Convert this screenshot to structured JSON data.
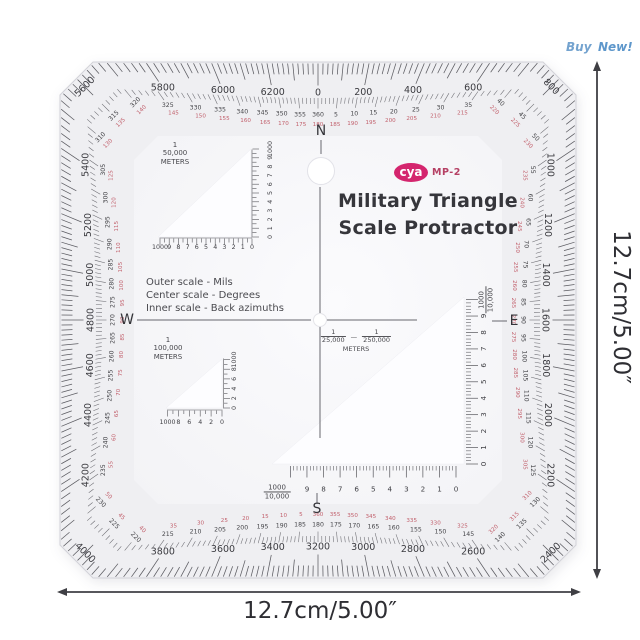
{
  "buy_new": {
    "buy": "Buy",
    "new": "New!"
  },
  "dimensions": {
    "right_label": "12.7cm/5.00″",
    "bottom_label": "12.7cm/5.00″"
  },
  "product": {
    "logo": {
      "brand": "cya",
      "model": "MP-2"
    },
    "title_line1": "Military Triangle",
    "title_line2": "Scale Protractor",
    "notes": [
      "Outer scale - Mils",
      "Center scale - Degrees",
      "Inner scale - Back azimuths"
    ],
    "compass": {
      "north": "N",
      "south": "S",
      "east": "E",
      "west": "W"
    },
    "center_scales": {
      "frac1_num": "1",
      "frac1_den": "25,000",
      "dash": "—",
      "frac2_num": "1",
      "frac2_den": "250,000",
      "unit": "METERS"
    },
    "triangle_50k": {
      "frac_num": "1",
      "frac_den": "50,000",
      "unit": "METERS",
      "bottom_scale": [
        "1000",
        "9",
        "8",
        "7",
        "6",
        "5",
        "4",
        "3",
        "2",
        "1",
        "0"
      ],
      "side_scale": [
        "0",
        "1",
        "2",
        "3",
        "4",
        "5",
        "6",
        "7",
        "8",
        "9",
        "1000"
      ]
    },
    "triangle_100k": {
      "frac_num": "1",
      "frac_den": "100,000",
      "unit": "METERS",
      "bottom_scale": [
        "1000",
        "8",
        "6",
        "4",
        "2",
        "0"
      ],
      "side_scale": [
        "0",
        "2",
        "4",
        "6",
        "8",
        "1000"
      ]
    },
    "triangle_10k": {
      "frac_num": "1000",
      "frac_den": "10,000",
      "bottom_scale": [
        "9",
        "8",
        "7",
        "6",
        "5",
        "4",
        "3",
        "2",
        "1",
        "0"
      ],
      "side_scale": [
        "9",
        "8",
        "7",
        "6",
        "5",
        "4",
        "3",
        "2",
        "1",
        "0"
      ]
    },
    "scales": {
      "mils": {
        "min": 0,
        "max": 6400,
        "number_step": 200,
        "tick_step": 20
      },
      "degrees": {
        "number_step": 5,
        "tick_step": 1,
        "back_azimuth_offset": 180
      }
    }
  },
  "colors": {
    "logo_pink": "#d4256e",
    "logo_model_red": "#b54064",
    "scale_red": "#c2616d",
    "scale_black": "#3f3f44",
    "buy_blue": "#6f9fce",
    "body_tint": "#efeff2",
    "annotation": "#35353a"
  }
}
